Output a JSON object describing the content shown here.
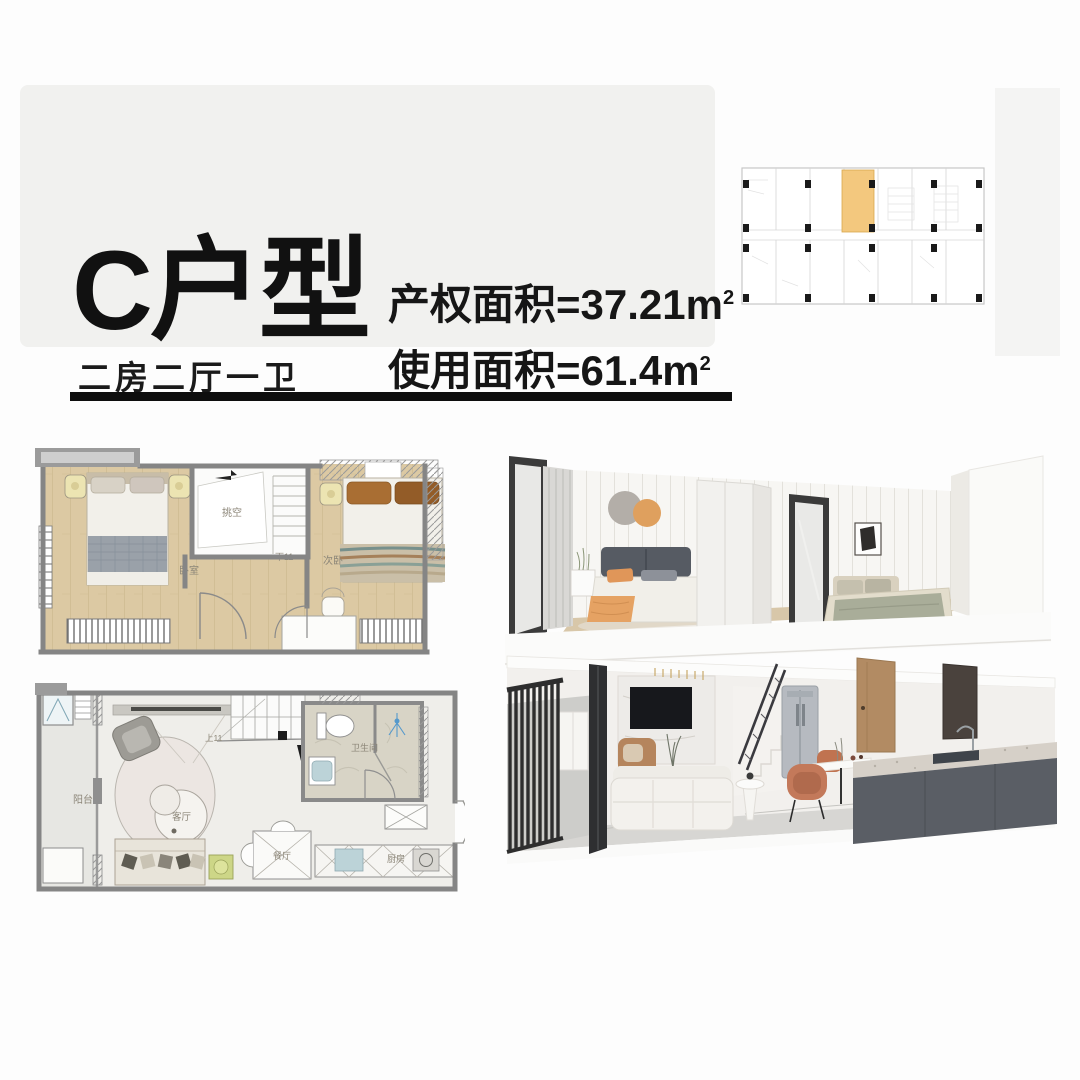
{
  "page": {
    "bg": "#fdfdfd"
  },
  "header": {
    "title": "C户型",
    "subtitle": "二房二厅一卫",
    "area_property": {
      "text": "产权面积=37.21m",
      "sup": "2"
    },
    "area_usable": {
      "text": "使用面积=61.4m",
      "sup": "2"
    }
  },
  "key_plan": {
    "highlight_color": "#f3c87e"
  },
  "upper_plan": {
    "labels": {
      "master_bedroom": "卧室",
      "void": "挑空",
      "stairs_down": "下11",
      "second_bedroom": "次卧"
    }
  },
  "lower_plan": {
    "labels": {
      "balcony": "阳台",
      "living_room": "客厅",
      "stairs_up": "上11",
      "bathroom": "卫生间",
      "dining_room": "餐厅",
      "kitchen": "厨房"
    }
  },
  "colors": {
    "wood_floor": "#dcc9a3",
    "wall_gray": "#8a8a8a",
    "marble": "#d8d4c6",
    "underline": "#0e0e0e",
    "card_bg": "#f1f1ef"
  }
}
